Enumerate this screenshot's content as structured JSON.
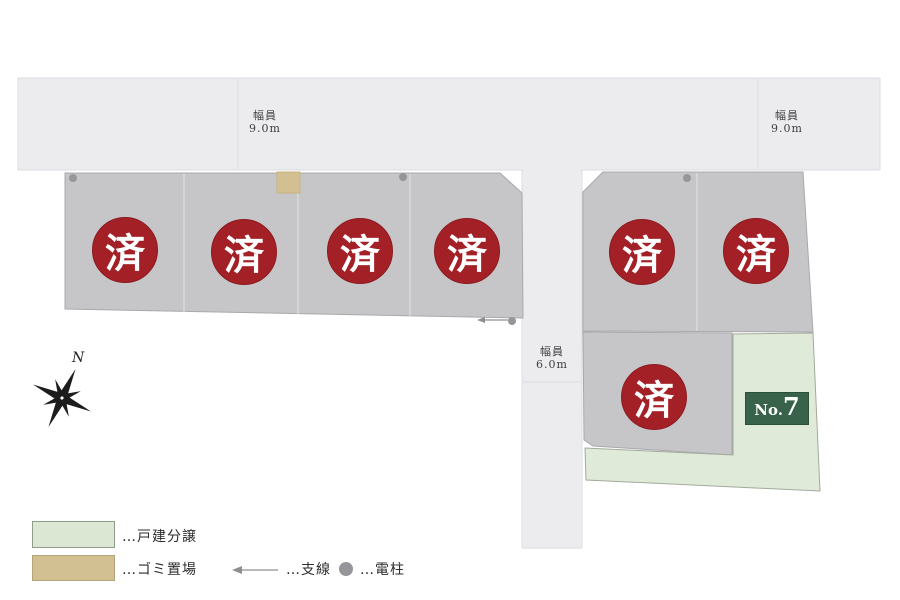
{
  "plan": {
    "road_width_labels": {
      "top_left": {
        "line1": "幅員",
        "line2": "9.0m"
      },
      "top_right": {
        "line1": "幅員",
        "line2": "9.0m"
      },
      "vertical": {
        "line1": "幅員",
        "line2": "6.0m"
      }
    },
    "sold_badge": "済",
    "available_lot": {
      "prefix": "No.",
      "number": "7"
    }
  },
  "compass": {
    "north_label": "N"
  },
  "legend": {
    "detached_housing": "…戸建分譲",
    "garbage_area": "…ゴミ置場",
    "branch_line": "…支線",
    "utility_pole": "…電柱"
  },
  "colors": {
    "road_gray": "#ececef",
    "lot_gray": "#c6c6c9",
    "sold_red": "#a32026",
    "available_green": "#e0ead8",
    "label_green": "#38634a",
    "garbage_tan": "#d2bf92",
    "legend_green": "#dbe7d2"
  }
}
